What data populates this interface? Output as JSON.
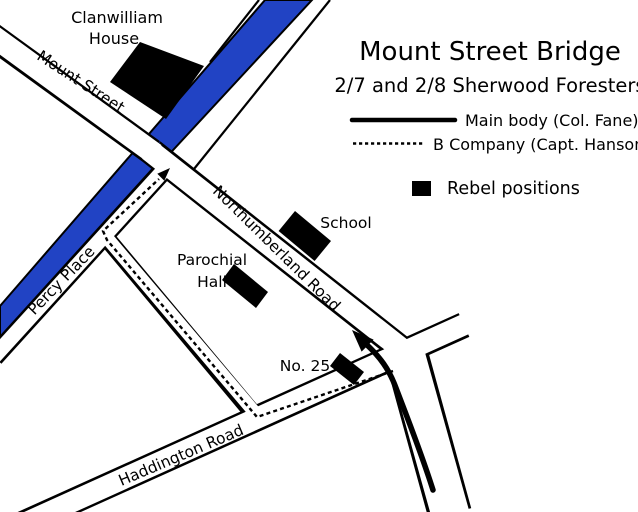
{
  "title": "Mount Street Bridge",
  "subtitle": "2/7 and 2/8 Sherwood Foresters",
  "legend": {
    "main_body_label": "Main body (Col. Fane)",
    "b_company_label": "B Company (Capt. Hanson)",
    "rebel_label": "Rebel positions"
  },
  "map_labels": {
    "clanwilliam_line1": "Clanwilliam",
    "clanwilliam_line2": "House",
    "mount_street": "Mount Street",
    "percy_place": "Percy Place",
    "northumberland_road": "Northumberland Road",
    "school": "School",
    "parochial_line1": "Parochial",
    "parochial_line2": "Hall",
    "no_25": "No. 25",
    "haddington_road": "Haddington Road"
  },
  "colors": {
    "canal": "#2143c4",
    "ink": "#000000",
    "background": "#ffffff"
  }
}
